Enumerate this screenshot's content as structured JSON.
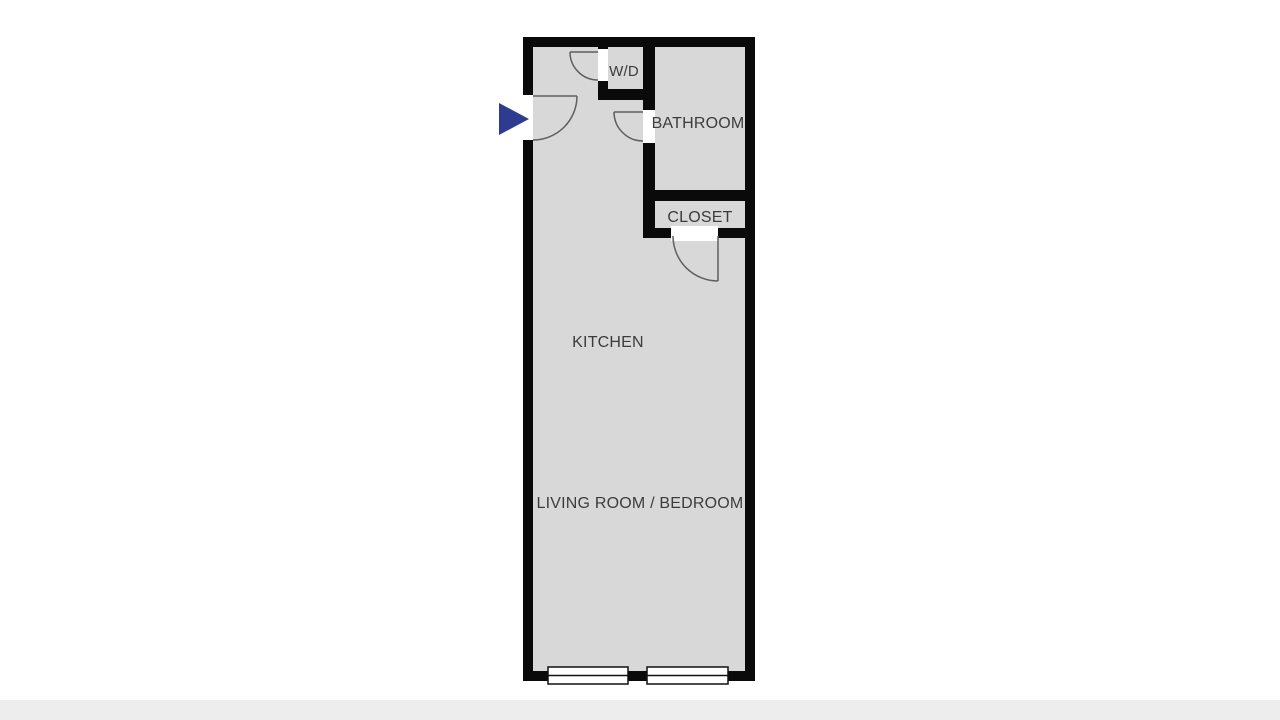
{
  "page": {
    "background": "#ffffff",
    "footer_bar_color": "#ededed"
  },
  "floorplan": {
    "colors": {
      "wall": "#0a0a0a",
      "floor": "#d8d8d8",
      "opening": "#ffffff",
      "door_swing": "#5f5f5f",
      "window_frame": "#111111",
      "window_fill": "#ffffff",
      "label_text": "#3c3c3c",
      "entry_arrow": "#2e3c8f"
    },
    "rooms": [
      {
        "id": "wd-closet",
        "label": "W/D"
      },
      {
        "id": "bathroom",
        "label": "BATHROOM"
      },
      {
        "id": "closet",
        "label": "CLOSET"
      },
      {
        "id": "kitchen",
        "label": "KITCHEN"
      },
      {
        "id": "living-room-bedroom",
        "label": "LIVING ROOM / BEDROOM"
      }
    ],
    "doors": [
      {
        "id": "entrance-door"
      },
      {
        "id": "wd-door"
      },
      {
        "id": "bathroom-door"
      },
      {
        "id": "closet-door"
      }
    ],
    "window_count": "2"
  }
}
